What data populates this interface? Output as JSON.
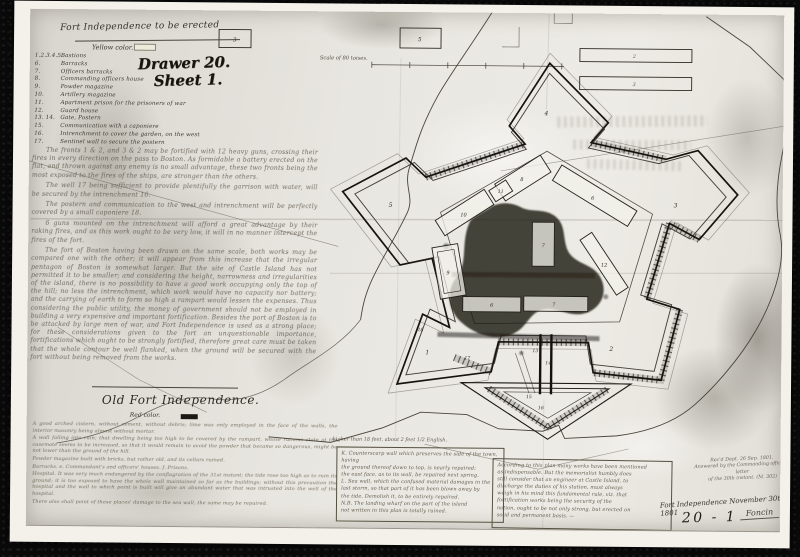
{
  "colors": {
    "mount": "#0a0a0a",
    "photo_border": "#f3f1ea",
    "paper": "#e8e6e0",
    "ink": "#17140f",
    "faded_ink": "#4c4536"
  },
  "title_block": {
    "title": "Fort Independence to be erected",
    "yellow_key": "Yellow color.",
    "drawer_stamp_line1": "Drawer 20.",
    "drawer_stamp_line2": "Sheet 1."
  },
  "legend": {
    "items": [
      {
        "num": "1.2.3.4.5.",
        "label": "Bastions"
      },
      {
        "num": "6.",
        "label": "Barracks"
      },
      {
        "num": "7.",
        "label": "Officers barracks"
      },
      {
        "num": "8.",
        "label": "Commanding officers house"
      },
      {
        "num": "9.",
        "label": "Powder magazine"
      },
      {
        "num": "10.",
        "label": "Artillery magazine"
      },
      {
        "num": "11.",
        "label": "Apartment prison for the prisoners of war"
      },
      {
        "num": "12.",
        "label": "Guard house"
      },
      {
        "num": "13. 14.",
        "label": "Gate, Postern"
      },
      {
        "num": "15.",
        "label": "Communication with a caponiere"
      },
      {
        "num": "16.",
        "label": "Intrenchment to cover the garden, on the west"
      },
      {
        "num": "17.",
        "label": "Sentinel wall to secure the postern"
      }
    ]
  },
  "notes": {
    "paragraphs": [
      "The fronts 1 & 2, and 3 & 2 may be fortified with 12 heavy guns, crossing their fires in every direction on the pass to Boston. As formidable a battery erected on the flat, and thrown against any enemy is no small advantage, these two fronts being the most exposed to the fires of the ships, are stronger than the others.",
      "The well 17 being sufficient to provide plentifully the garrison with water, will be secured by the intrenchment 16.",
      "The postern and communication to the west and intrenchment will be perfectly covered by a small caponiere 18.",
      "6 guns mounted on the intrenchment will afford a great advantage by their raking fires, and as this work ought to be very low, it will in no manner intercept the fires of the fort.",
      "The fort of Boston having been drawn on the same scale, both works may be compared one with the other; it will appear from this increase that the irregular pentagon of Boston is somewhat larger. But the site of Castle Island has not permitted it to be smaller; and considering the height, narrowness and irregularities of the island, there is no possibility to have a good work occupying only the top of the hill; no less the intrenchment, which work would have no capacity nor battery; and the carrying of earth to form so high a rampart would lessen the expenses. Thus considering the public utility, the money of government should not be employed in building a very expensive and important fortification. Besides the port of Boston is to be attacked by large men of war, and Fort Independence is used as a strong place; for these considerations given to the fort an unquestionable importance, fortifications which ought to be strongly fortified, therefore great care must be taken that the whole contour be well flanked, when the ground will be secured with the fort without being removed from the works."
    ]
  },
  "old_fort_section": {
    "heading": "Old Fort Independence.",
    "red_key": "Red color.",
    "items": [
      {
        "letter": "a.",
        "text": "A good arched cistern, without cement, without debris; lime was only employed in the face of the walls, the interior masonry being almost without mortar."
      },
      {
        "letter": "b.",
        "text": "A wall falling into ruin; that dwelling being too high to be covered by the rampart, whose ruinous state at the casemate seems to be increased, so that it would remain to avoid the powder that became so dangerous, might be not lower than the ground of the hill."
      },
      {
        "letter": "c.",
        "text": "Powder magazine built with bricks, but rather old, and its cellars ruined."
      },
      {
        "letter": "d.",
        "text": "Barracks.    e. Commandant's and officers' houses.    f. Prisons."
      },
      {
        "letter": "g.",
        "text": "Hospital. It was very much endangered by the conflagration of the 31st instant; the tide rose too high as to ruin its ground; it is too exposed to have the whole wall maintained so far as the buildings; without this precaution the hospital and the wall to which point is built will give an abundant water that was intrusted into the well of the hospital."
      },
      {
        "letter": "h.",
        "text": "There also shall point of these places' damage to the sea wall, the same may be repaired."
      }
    ]
  },
  "bottom_boxes": {
    "caption": "higher than 18 feet, about 2 feet 1/2 English.",
    "left_lines": [
      "K. Counterscarp wall which preserves the side of the town, having",
      "the ground thereof down to top, is nearly repaired;",
      "the east face, as to its wall, be repaired next spring.",
      "L. Sea wall, which the confused material damages in the",
      "last storm, so that part of it has been blown away by",
      "the tide. Demolish it, to be entirely repaired.",
      "N.B. The landing wharf on the part of the island",
      "not written in this plan is totally ruined."
    ],
    "right_lines": [
      "According to this plan many works have been mentioned",
      "as indispensable. But the memorialist humbly does",
      "still consider that an engineer at Castle Island, to",
      "discharge the duties of his station, must always",
      "weigh in his mind this fundamental rule, viz. that",
      "fortification works being the security of the",
      "nation, ought to be not only strong, but erected on",
      "solid and permanent basis. —"
    ]
  },
  "stamps": {
    "received_lines": [
      "Rec'd Dept. 26 Sep. 1801.",
      "Answered by the Commanding officer's letter",
      "of the 30th instant.  (M. 302)"
    ],
    "docket_title": "Fort Independence November 30th 1801",
    "sheet_number": "20 - 1",
    "signature": "Foncin"
  },
  "plan": {
    "scale_label": "Scale of 80 toises.",
    "bastions": [
      "1",
      "2",
      "3",
      "4",
      "5"
    ],
    "buildings": [
      "6",
      "7",
      "8",
      "9",
      "10",
      "11",
      "12"
    ],
    "outworks": [
      "13",
      "14",
      "15",
      "16",
      "17",
      "18"
    ],
    "ref_boxes": [
      "3",
      "5",
      "2",
      "3"
    ]
  }
}
